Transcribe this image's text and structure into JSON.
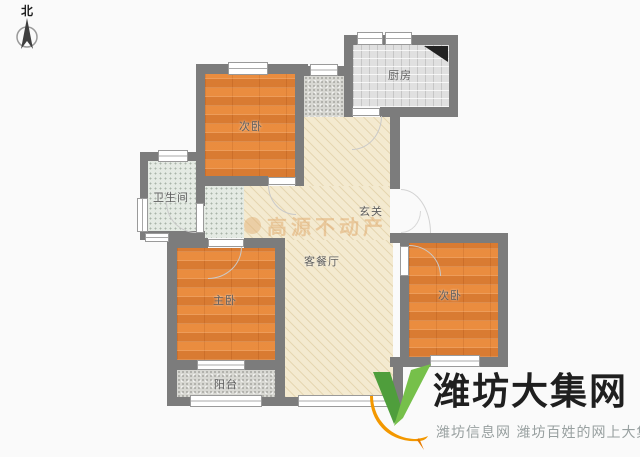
{
  "compass": {
    "label": "北",
    "icon": "north-arrow"
  },
  "rooms": {
    "bedroom_top": {
      "label": "次卧"
    },
    "kitchen": {
      "label": "厨房"
    },
    "bathroom": {
      "label": "卫生间"
    },
    "hallway": {
      "label": "玄关"
    },
    "living_dining": {
      "label": "客餐厅"
    },
    "master_bedroom": {
      "label": "主卧"
    },
    "bedroom_right": {
      "label": "次卧"
    },
    "balcony": {
      "label": "阳台"
    }
  },
  "watermark": {
    "text": "高源不动产"
  },
  "brand": {
    "name": "潍坊大集网",
    "tagline": "潍坊信息网 潍坊百姓的网上大集",
    "icon": "v-check-with-orange-swoosh",
    "colors": {
      "green": "#76c04a",
      "dark_green": "#4f9e3c",
      "orange": "#f39800",
      "name_text": "#1f1f1f",
      "tagline_gray": "#98a0a0"
    }
  },
  "palette": {
    "wall": "#7c7c7c",
    "wood_floor": "#e6873a",
    "living_floor": "#f4ead0",
    "kitchen_floor": "#e0e0e0",
    "bath_floor": "#e4eae3",
    "balcony_floor": "#d8d8d3",
    "label_text": "#5e5e5e",
    "background": "#fafafa"
  }
}
